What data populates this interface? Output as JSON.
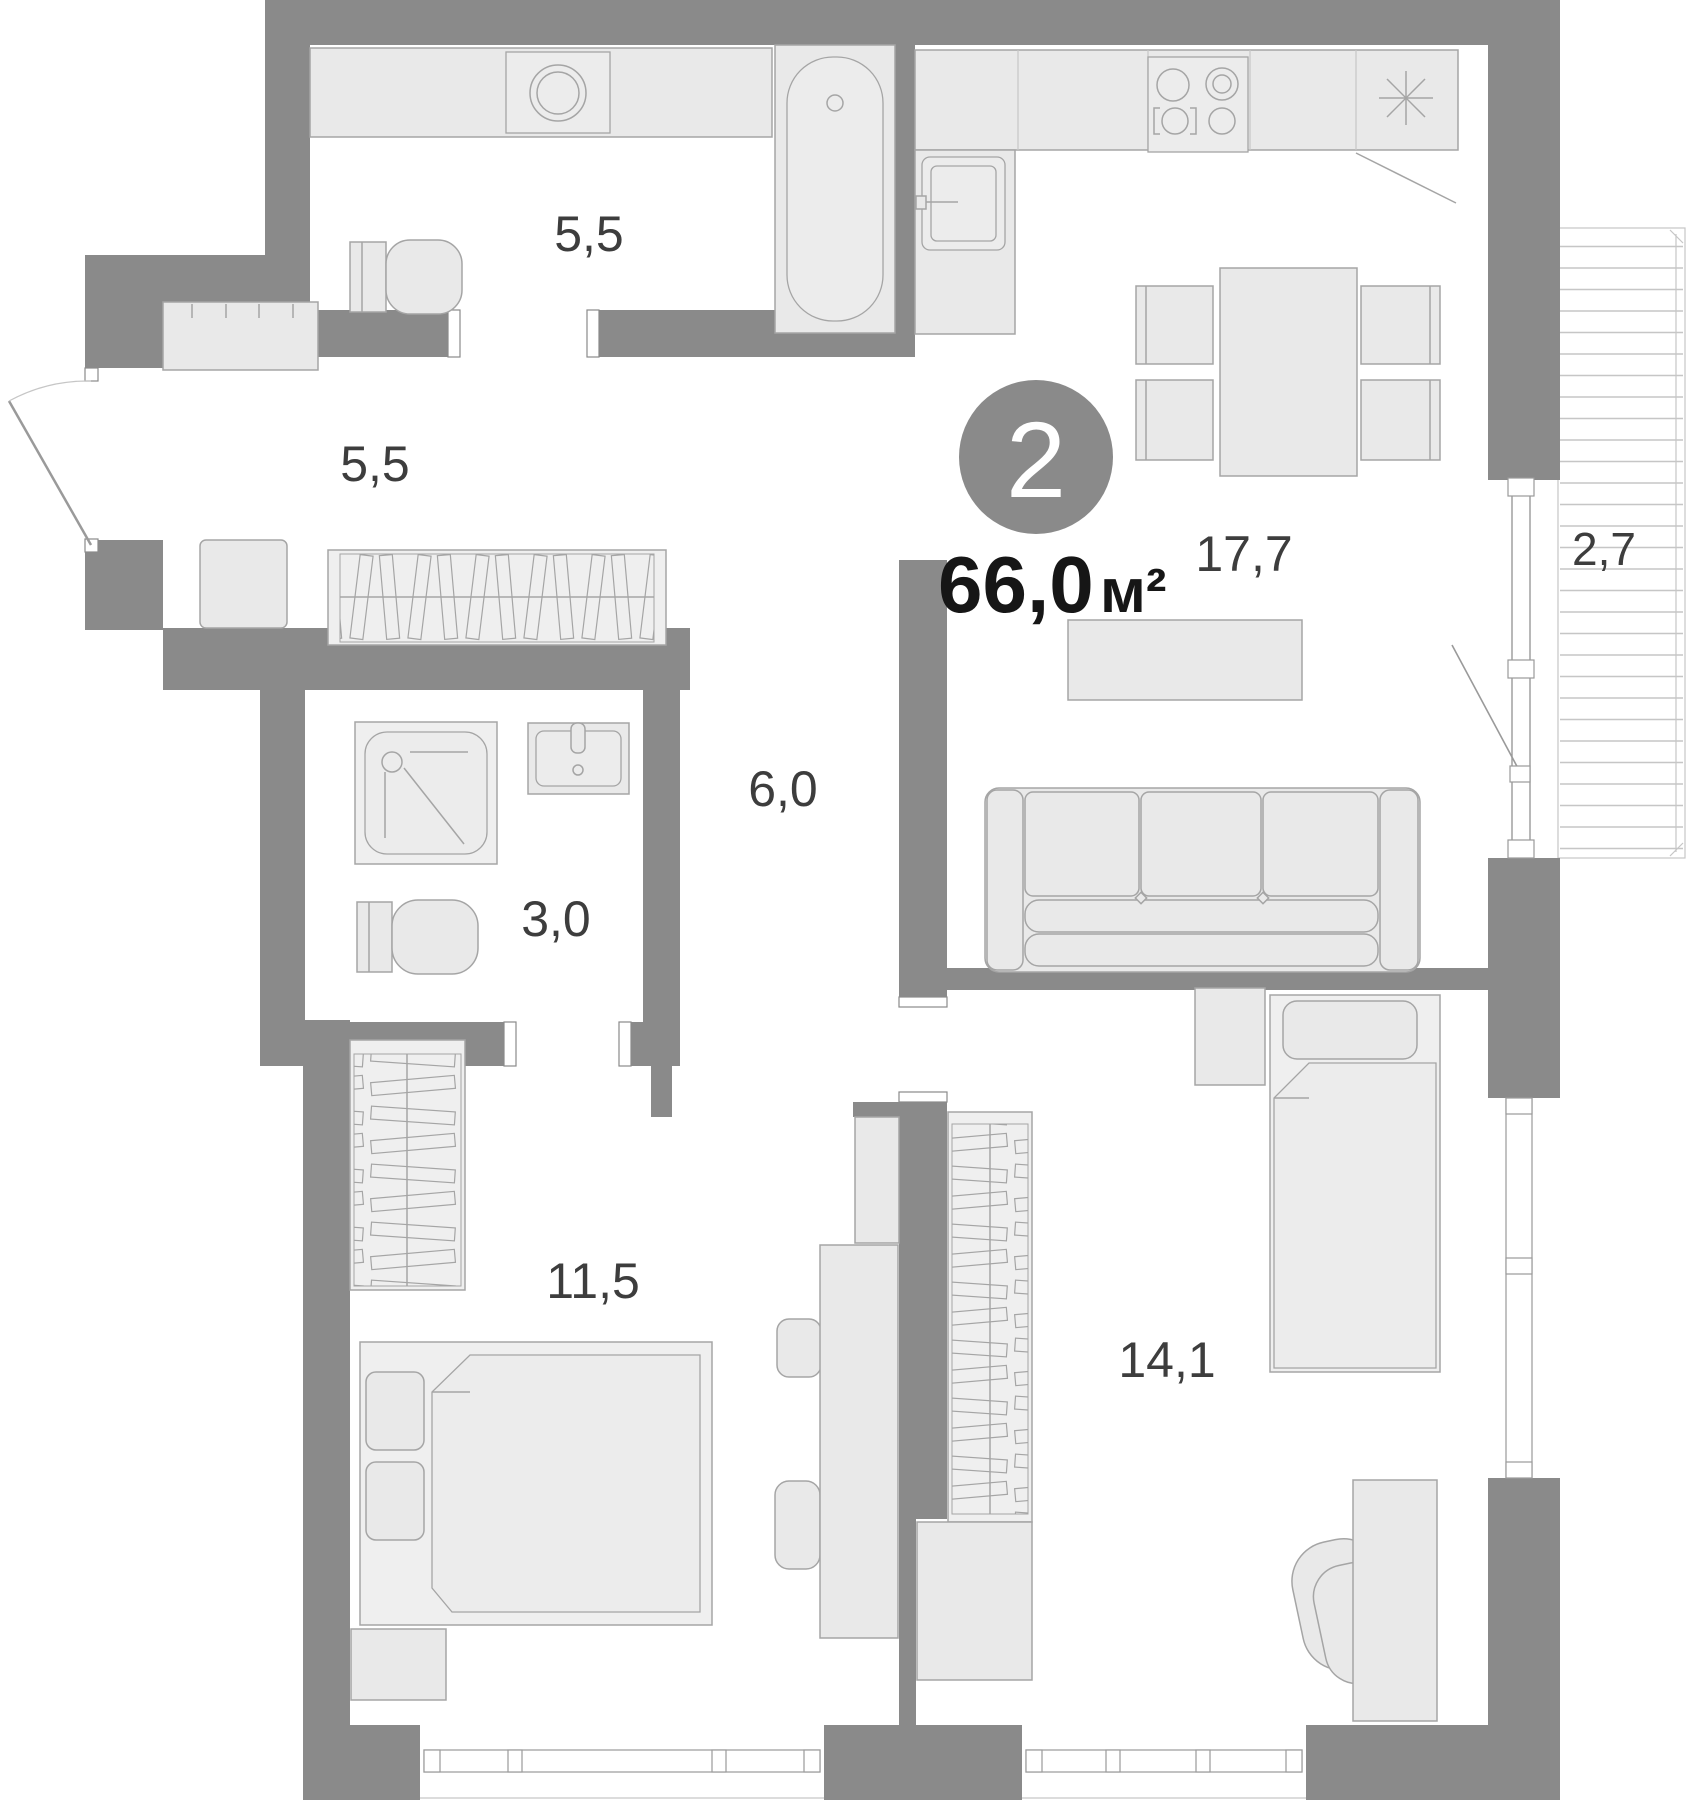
{
  "plan": {
    "type": "apartment-floor-plan",
    "badge": {
      "rooms_count": "2"
    },
    "total_area": {
      "value": "66,0",
      "unit": "м²"
    },
    "rooms": [
      {
        "id": "bathroom",
        "label": "5,5"
      },
      {
        "id": "hallway",
        "label": "5,5"
      },
      {
        "id": "kitchen-living-room",
        "label": "17,7"
      },
      {
        "id": "balcony",
        "label": "2,7"
      },
      {
        "id": "corridor",
        "label": "6,0"
      },
      {
        "id": "shower-room",
        "label": "3,0"
      },
      {
        "id": "bedroom",
        "label": "11,5"
      },
      {
        "id": "bedroom-second",
        "label": "14,1"
      }
    ],
    "colors": {
      "wall": "#8a8a8a",
      "room_floor": "#ffffff",
      "furniture_fill": "#e9e9e9",
      "furniture_stroke": "#a5a5a5",
      "label_text": "#3d3d3d",
      "area_text": "#161616",
      "badge_fill": "#8a8a8a",
      "badge_text": "#ffffff",
      "balcony_hatch": "#c6c6c6"
    }
  }
}
